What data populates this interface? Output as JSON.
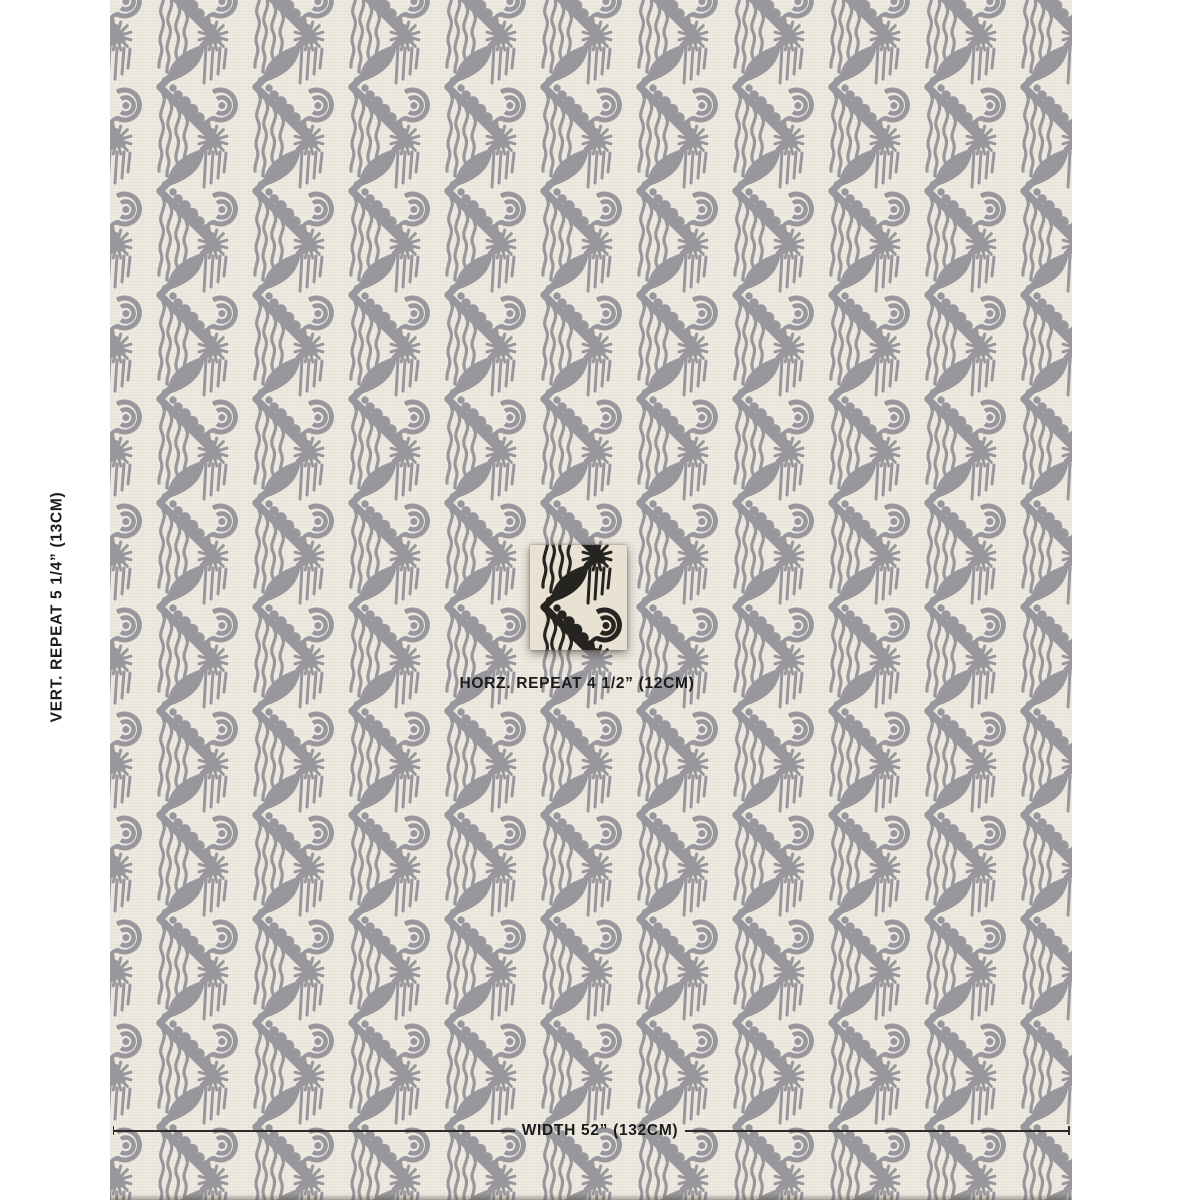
{
  "product_image": {
    "type": "fabric-swatch-with-repeat-annotations",
    "pattern_style": "art-deco zigzag chevron with sunburst, oval, dotted band, wave curl and wavy fringe, vertical column repeat"
  },
  "annotations": {
    "vertical_repeat": "VERT. REPEAT 5 1/4” (13CM)",
    "horizontal_repeat": "HORZ. REPEAT 4 1/2” (12CM)",
    "width": "WIDTH 52” (132CM)"
  },
  "measurements": {
    "vertical_repeat_in": "5 1/4”",
    "vertical_repeat_cm": "13CM",
    "horizontal_repeat_in": "4 1/2”",
    "horizontal_repeat_cm": "12CM",
    "width_in": "52”",
    "width_cm": "132CM"
  },
  "colors": {
    "page_bg": "#FFFFFF",
    "fabric_cream": "#EFEBE2",
    "pattern_gray": "#98979D",
    "swatch_bg": "#E9E1D2",
    "swatch_ink": "#262420",
    "text_ink": "#1B1B1B",
    "measure_line": "#2B2B2B"
  }
}
